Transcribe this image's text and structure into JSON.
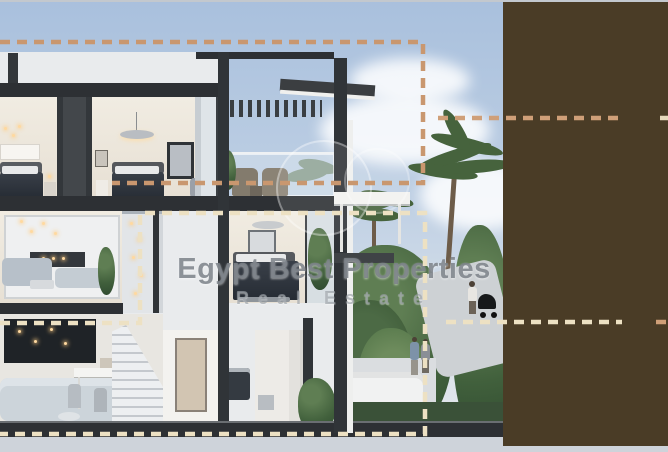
{
  "watermark": {
    "brand": "Egypt Best Properties",
    "tagline": "Real Estate"
  },
  "annotations": {
    "upper_unit_outline_color": "#c9976f",
    "lower_unit_outline_color": "#ede1c3",
    "upper_leader_color": "#cf9f78",
    "lower_leader_color": "#ede1c3",
    "upper_fragment_color": "#e6d9bc",
    "lower_fragment_color": "#cf9f78"
  },
  "redaction_blocks": {
    "color": "#4a3c26"
  },
  "scene_colors": {
    "sky_top": "#a9c0dd",
    "sky_bottom": "#e3e7ec",
    "background_margin": "#ced3da",
    "structure_dark": "#2d3034",
    "foliage_dark": "#2f4a30"
  }
}
